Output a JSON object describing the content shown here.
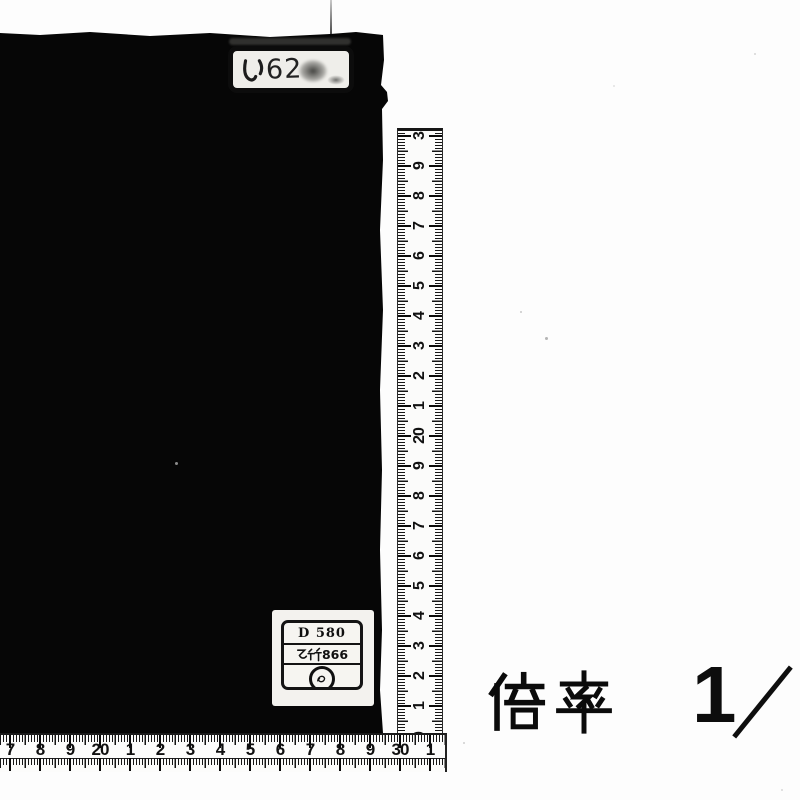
{
  "page": {
    "background": "#ffffff",
    "type": "scanned plate"
  },
  "colors": {
    "ink": "#0b0b0b",
    "paper": "#fdfdfd",
    "object": "#060606",
    "label_paper": "#efeeea"
  },
  "top_label": {
    "text": "い62",
    "kana": "い",
    "digits": "62"
  },
  "bottom_label": {
    "row1": "D 580",
    "row2": "乙竹866",
    "row2_kanji": "乙竹",
    "row2_digits": "866",
    "stamp": "circular ink stamp"
  },
  "caption": {
    "full": "倍率 1／",
    "kanji": "倍率",
    "numerator": "1",
    "slash": "／"
  },
  "rulers": {
    "unit": "cm",
    "horizontal": {
      "labels": [
        "7",
        "8",
        "9",
        "20",
        "1",
        "2",
        "3",
        "4",
        "5",
        "6",
        "7",
        "8",
        "9",
        "30",
        "1"
      ],
      "start_px": 10,
      "step_px": 30
    },
    "vertical": {
      "labels": [
        "3",
        "9",
        "8",
        "7",
        "6",
        "5",
        "4",
        "3",
        "2",
        "1",
        "20",
        "9",
        "8",
        "7",
        "6",
        "5",
        "4",
        "3",
        "2",
        "1",
        "0"
      ],
      "start_px": 5,
      "step_px": 30
    }
  }
}
